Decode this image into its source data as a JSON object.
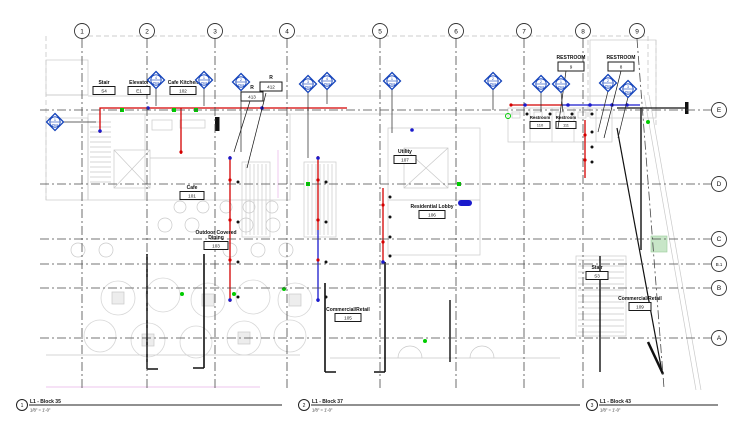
{
  "sheet": {
    "background": "#ffffff"
  },
  "colors": {
    "pipe_supply_red": "#d40000",
    "pipe_waste_blue": "#1a1acc",
    "valve_green": "#00cc00",
    "fixture_tag_blue": "#1544bb",
    "grid_line": "#4a4a4a",
    "linework_gray": "#c9c9c9",
    "background": "#ffffff"
  },
  "grid": {
    "columns": [
      {
        "label": "1",
        "x": 82
      },
      {
        "label": "2",
        "x": 147
      },
      {
        "label": "3",
        "x": 215
      },
      {
        "label": "4",
        "x": 287
      },
      {
        "label": "5",
        "x": 380
      },
      {
        "label": "6",
        "x": 456
      },
      {
        "label": "7",
        "x": 524
      },
      {
        "label": "8",
        "x": 583
      },
      {
        "label": "9",
        "x": 637,
        "slant": true
      }
    ],
    "rows": [
      {
        "label": "E",
        "y": 110
      },
      {
        "label": "D",
        "y": 184
      },
      {
        "label": "C",
        "y": 239
      },
      {
        "label": "B.1",
        "y": 264
      },
      {
        "label": "B",
        "y": 288
      },
      {
        "label": "A",
        "y": 338
      }
    ]
  },
  "rooms": [
    {
      "name": "Stair",
      "number": "S4",
      "x": 104,
      "y": 84,
      "bw": 22
    },
    {
      "name": "Elevator",
      "number": "E1",
      "x": 139,
      "y": 84,
      "bw": 22
    },
    {
      "name": "Cafe Kitchen",
      "number": "102",
      "x": 183,
      "y": 84,
      "bw": 26
    },
    {
      "name": "Cafe",
      "number": "101",
      "x": 192,
      "y": 189,
      "bw": 24
    },
    {
      "name": "Outdoor Covered|Dining",
      "number": "103",
      "x": 216,
      "y": 234,
      "bw": 24
    },
    {
      "name": "Utility",
      "number": "107",
      "x": 405,
      "y": 153,
      "bw": 22
    },
    {
      "name": "Residential Lobby",
      "number": "106",
      "x": 432,
      "y": 208,
      "bw": 26
    },
    {
      "name": "Commercial/Retail",
      "number": "105",
      "x": 348,
      "y": 311,
      "bw": 26
    },
    {
      "name": "Stair",
      "number": "S3",
      "x": 597,
      "y": 269,
      "bw": 22
    },
    {
      "name": "Commercial/Retail",
      "number": "109",
      "x": 640,
      "y": 300,
      "bw": 22
    },
    {
      "name": "Restroom",
      "number": "110",
      "x": 540,
      "y": 119,
      "bw": 20,
      "small": true
    },
    {
      "name": "Restroom",
      "number": "111",
      "x": 566,
      "y": 119,
      "bw": 20,
      "small": true
    }
  ],
  "keynotes": [
    {
      "label": "R",
      "number": "413",
      "x": 252,
      "y": 89,
      "bw": 22,
      "leader": [
        250,
        101,
        234,
        152
      ]
    },
    {
      "label": "R",
      "number": "412",
      "x": 271,
      "y": 79,
      "bw": 22,
      "leader": [
        266,
        93,
        247,
        168
      ]
    },
    {
      "label": "RESTROOM",
      "number": "9",
      "x": 571,
      "y": 59,
      "bw": 26,
      "leader": [
        566,
        71,
        558,
        128
      ]
    },
    {
      "label": "RESTROOM",
      "number": "8",
      "x": 621,
      "y": 59,
      "bw": 26,
      "leader": [
        621,
        71,
        604,
        138
      ]
    }
  ],
  "fixture_label": "PS02",
  "fixture_tags": [
    {
      "num": "1",
      "x": 55,
      "y": 122,
      "ex": 55,
      "ey": 122
    },
    {
      "num": "4",
      "x": 156,
      "y": 80,
      "ex": 156,
      "ey": 106
    },
    {
      "num": "1",
      "x": 204,
      "y": 80,
      "ex": 204,
      "ey": 106
    },
    {
      "num": "2",
      "x": 241,
      "y": 82,
      "ex": 241,
      "ey": 152
    },
    {
      "num": "3",
      "x": 308,
      "y": 84,
      "ex": 308,
      "ey": 158
    },
    {
      "num": "4",
      "x": 327,
      "y": 81,
      "ex": 327,
      "ey": 104
    },
    {
      "num": "1",
      "x": 392,
      "y": 81,
      "ex": 392,
      "ey": 133
    },
    {
      "num": "2",
      "x": 493,
      "y": 81,
      "ex": 493,
      "ey": 110
    },
    {
      "num": "2",
      "x": 541,
      "y": 84,
      "ex": 541,
      "ey": 112
    },
    {
      "num": "1",
      "x": 561,
      "y": 84,
      "ex": 563,
      "ey": 112
    },
    {
      "num": "2",
      "x": 608,
      "y": 83,
      "ex": 598,
      "ey": 132
    },
    {
      "num": "3",
      "x": 628,
      "y": 89,
      "ex": 618,
      "ey": 138
    }
  ],
  "title_block": {
    "view_titles": [
      {
        "number": "1",
        "name": "L1 - Block 35",
        "scale": "1/8\" = 1'-0\"",
        "cx": 22,
        "line_end": 282
      },
      {
        "number": "2",
        "name": "L1 - Block 37",
        "scale": "1/8\" = 1'-0\"",
        "cx": 304,
        "line_end": 580
      },
      {
        "number": "3",
        "name": "L1 - Block 43",
        "scale": "1/8\" = 1'-0\"",
        "cx": 592,
        "line_end": 718
      }
    ]
  }
}
